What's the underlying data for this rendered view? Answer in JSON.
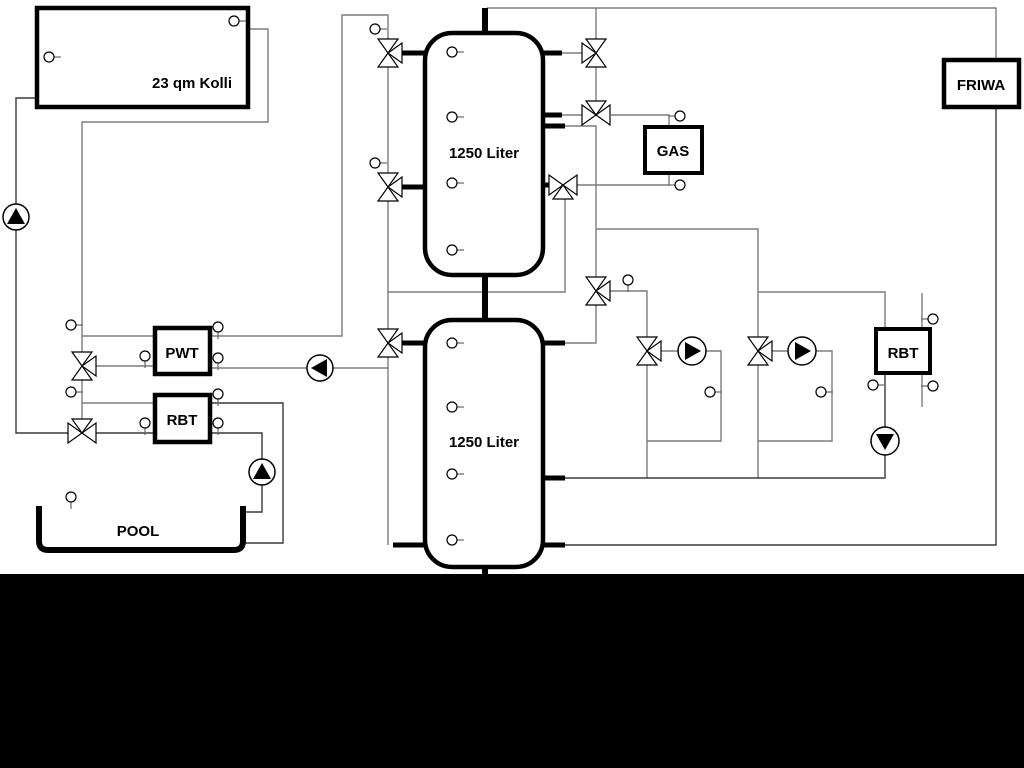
{
  "diagram": {
    "labels": {
      "collector": "23 qm Kolli",
      "tank1": "1250 Liter",
      "tank2": "1250 Liter",
      "gas": "GAS",
      "friwa": "FRIWA",
      "pwt": "PWT",
      "rbt_left": "RBT",
      "rbt_right": "RBT",
      "pool": "POOL"
    },
    "colors": {
      "background": "#ffffff",
      "line_gray": "#7d7d7d",
      "line_dark": "#3a3a3a",
      "pipe_black": "#000000",
      "footer": "#000000"
    },
    "components": {
      "pumps": [
        {
          "name": "solar-pump",
          "x": 16,
          "y": 217,
          "r": 13,
          "dir": "up"
        },
        {
          "name": "pwt-loop-pump",
          "x": 320,
          "y": 368,
          "r": 13,
          "dir": "left"
        },
        {
          "name": "pool-pump",
          "x": 262,
          "y": 472,
          "r": 13,
          "dir": "up"
        },
        {
          "name": "heating-circuit-1-pump",
          "x": 692,
          "y": 351,
          "r": 14,
          "dir": "right"
        },
        {
          "name": "heating-circuit-2-pump",
          "x": 802,
          "y": 351,
          "r": 14,
          "dir": "right"
        },
        {
          "name": "rbt-right-pump",
          "x": 885,
          "y": 441,
          "r": 14,
          "dir": "down"
        }
      ],
      "valves": [
        {
          "name": "tank1-top-left-valve",
          "x": 388,
          "y": 53,
          "third": "right"
        },
        {
          "name": "tank1-mid-left-valve",
          "x": 388,
          "y": 187,
          "third": "right"
        },
        {
          "name": "tank2-top-left-valve",
          "x": 388,
          "y": 343,
          "third": "right"
        },
        {
          "name": "pwt-supply-valve",
          "x": 82,
          "y": 366,
          "third": "right"
        },
        {
          "name": "solar-return-valve",
          "x": 82,
          "y": 433,
          "third": "top"
        },
        {
          "name": "tank1-top-right-valve",
          "x": 596,
          "y": 53,
          "third": "left"
        },
        {
          "name": "gas-supply-valve",
          "x": 596,
          "y": 115,
          "third": "top"
        },
        {
          "name": "gas-return-valve",
          "x": 563,
          "y": 185,
          "third": "bottom"
        },
        {
          "name": "tank-mid-right-valve",
          "x": 596,
          "y": 291,
          "third": "right"
        },
        {
          "name": "heating-circuit-1-valve",
          "x": 647,
          "y": 351,
          "third": "right"
        },
        {
          "name": "heating-circuit-2-valve",
          "x": 758,
          "y": 351,
          "third": "right"
        }
      ],
      "sensors": [
        {
          "name": "collector-sensor-top",
          "x": 234,
          "y": 21,
          "stub": "right"
        },
        {
          "name": "collector-sensor-left",
          "x": 49,
          "y": 57,
          "stub": "right"
        },
        {
          "name": "riser-sensor-top",
          "x": 375,
          "y": 29,
          "stub": "right"
        },
        {
          "name": "riser-sensor-mid",
          "x": 375,
          "y": 163,
          "stub": "right"
        },
        {
          "name": "solar-supply-sensor",
          "x": 71,
          "y": 325,
          "stub": "right"
        },
        {
          "name": "solar-return-sensor",
          "x": 71,
          "y": 392,
          "stub": "right"
        },
        {
          "name": "pwt-left-sensor",
          "x": 145,
          "y": 356,
          "stub": "down"
        },
        {
          "name": "rbt-left-sensor",
          "x": 145,
          "y": 423,
          "stub": "down"
        },
        {
          "name": "pwt-right-sensor-top",
          "x": 218,
          "y": 327,
          "stub": "down"
        },
        {
          "name": "pwt-right-sensor-bottom",
          "x": 218,
          "y": 358,
          "stub": "down"
        },
        {
          "name": "rbt-left-right-sensor-top",
          "x": 218,
          "y": 394,
          "stub": "down"
        },
        {
          "name": "rbt-left-right-sensor-bottom",
          "x": 218,
          "y": 423,
          "stub": "down"
        },
        {
          "name": "pool-sensor",
          "x": 71,
          "y": 497,
          "stub": "down"
        },
        {
          "name": "tank1-sensor-1",
          "x": 452,
          "y": 52,
          "stub": "right"
        },
        {
          "name": "tank1-sensor-2",
          "x": 452,
          "y": 117,
          "stub": "right"
        },
        {
          "name": "tank1-sensor-3",
          "x": 452,
          "y": 183,
          "stub": "right"
        },
        {
          "name": "tank1-sensor-4",
          "x": 452,
          "y": 250,
          "stub": "right"
        },
        {
          "name": "tank2-sensor-1",
          "x": 452,
          "y": 343,
          "stub": "right"
        },
        {
          "name": "tank2-sensor-2",
          "x": 452,
          "y": 407,
          "stub": "right"
        },
        {
          "name": "tank2-sensor-3",
          "x": 452,
          "y": 474,
          "stub": "right"
        },
        {
          "name": "tank2-sensor-4",
          "x": 452,
          "y": 540,
          "stub": "right"
        },
        {
          "name": "mid-supply-sensor",
          "x": 628,
          "y": 280,
          "stub": "down"
        },
        {
          "name": "gas-top-sensor",
          "x": 680,
          "y": 116,
          "stub": "left"
        },
        {
          "name": "gas-bottom-sensor",
          "x": 680,
          "y": 185,
          "stub": "left"
        },
        {
          "name": "heating-circuit-1-sensor",
          "x": 710,
          "y": 392,
          "stub": "right"
        },
        {
          "name": "heating-circuit-2-sensor",
          "x": 821,
          "y": 392,
          "stub": "right"
        },
        {
          "name": "rbt-right-return-sensor",
          "x": 873,
          "y": 385,
          "stub": "right"
        },
        {
          "name": "rbt-right-secondary-sensor-top",
          "x": 933,
          "y": 319,
          "stub": "left"
        },
        {
          "name": "rbt-right-secondary-sensor-bottom",
          "x": 933,
          "y": 386,
          "stub": "left"
        }
      ]
    }
  }
}
